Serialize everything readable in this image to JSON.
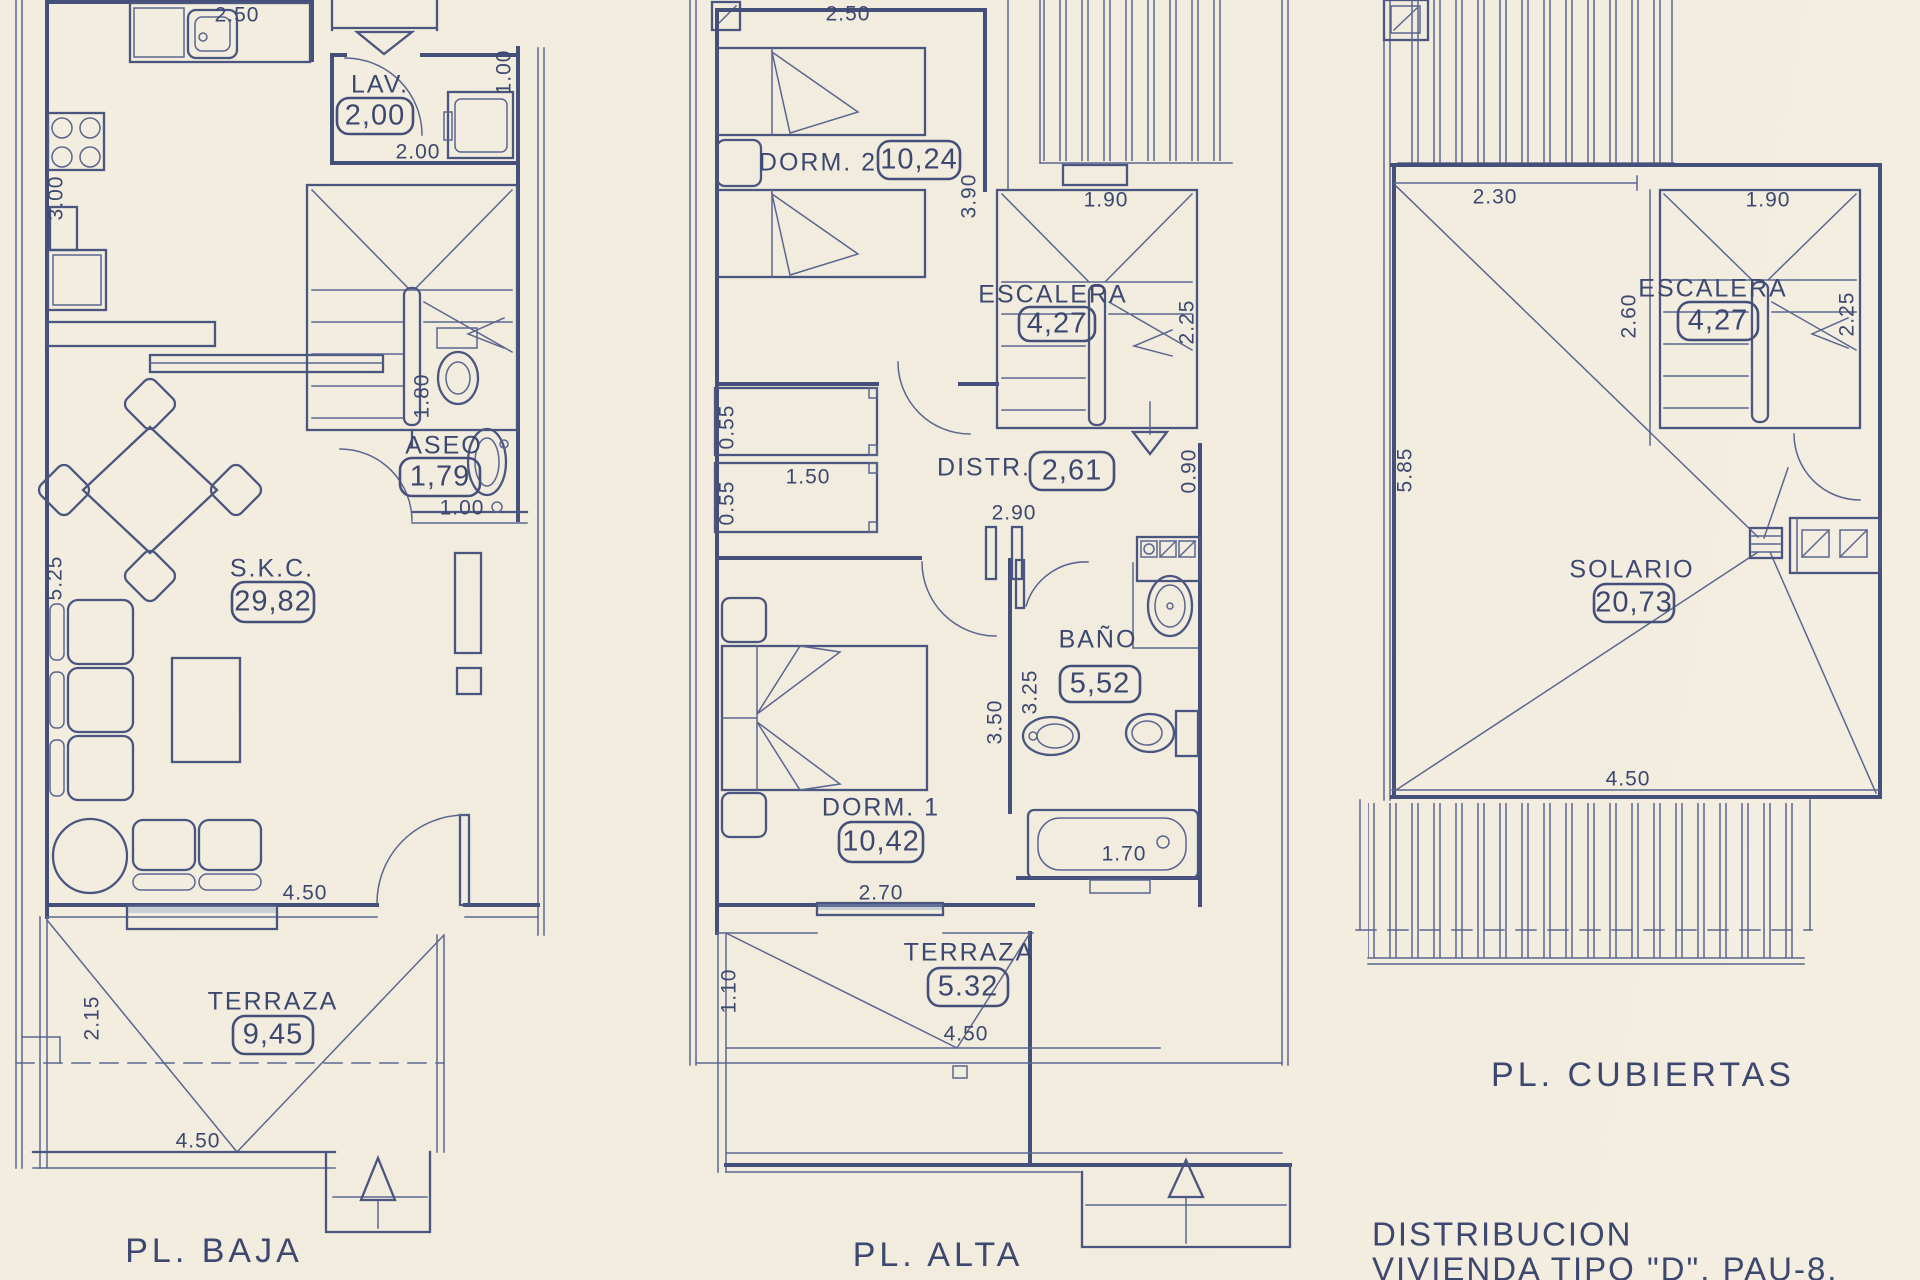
{
  "palette": {
    "paper": "#f1ecdf",
    "ink": "#44507a"
  },
  "sheet": {
    "title_line1": "DISTRIBUCION",
    "title_line2": "VIVIENDA TIPO \"D\". PAU-8."
  },
  "baja": {
    "title": "PL. BAJA",
    "rooms": {
      "lav": {
        "name": "LAV.",
        "area": "2,00"
      },
      "aseo": {
        "name": "ASEO",
        "area": "1,79"
      },
      "skc": {
        "name": "S.K.C.",
        "area": "29,82"
      },
      "terraza": {
        "name": "TERRAZA",
        "area": "9,45"
      }
    },
    "dims": {
      "kitchen_width": "2.50",
      "kitchen_depth": "3.00",
      "lav_width": "2.00",
      "lav_depth": "1.00",
      "aseo_depth": "1.80",
      "aseo_width": "1.00",
      "salon_depth": "5.25",
      "salon_width": "4.50",
      "terraza_depth": "2.15",
      "terraza_width": "4.50"
    }
  },
  "alta": {
    "title": "PL. ALTA",
    "rooms": {
      "dorm2": {
        "name": "DORM. 2",
        "area": "10,24"
      },
      "escalera": {
        "name": "ESCALERA",
        "area": "4,27"
      },
      "distr": {
        "name": "DISTR.",
        "area": "2,61"
      },
      "bano": {
        "name": "BAÑO",
        "area": "5,52"
      },
      "dorm1": {
        "name": "DORM. 1",
        "area": "10,42"
      },
      "terraza": {
        "name": "TERRAZA",
        "area": "5.32"
      }
    },
    "dims": {
      "dorm2_width": "2.50",
      "dorm2_depth": "3.90",
      "esc_width": "1.90",
      "esc_depth": "2.25",
      "closet_a": "0.55",
      "closet_b": "0.55",
      "closet_width": "1.50",
      "distr_depth": "0.90",
      "distr_width": "2.90",
      "bano_inner": "3.25",
      "bano_outer": "3.50",
      "bath_length": "1.70",
      "dorm1_width": "2.70",
      "terraza_depth": "1.10",
      "terraza_width": "4.50"
    }
  },
  "cubiertas": {
    "title": "PL. CUBIERTAS",
    "rooms": {
      "escalera": {
        "name": "ESCALERA",
        "area": "4,27"
      },
      "solario": {
        "name": "SOLARIO",
        "area": "20,73"
      }
    },
    "dims": {
      "top_width": "2.30",
      "esc_side": "2.60",
      "esc_width": "1.90",
      "esc_depth": "2.25",
      "left_depth": "5.85",
      "bottom_width": "4.50"
    }
  }
}
